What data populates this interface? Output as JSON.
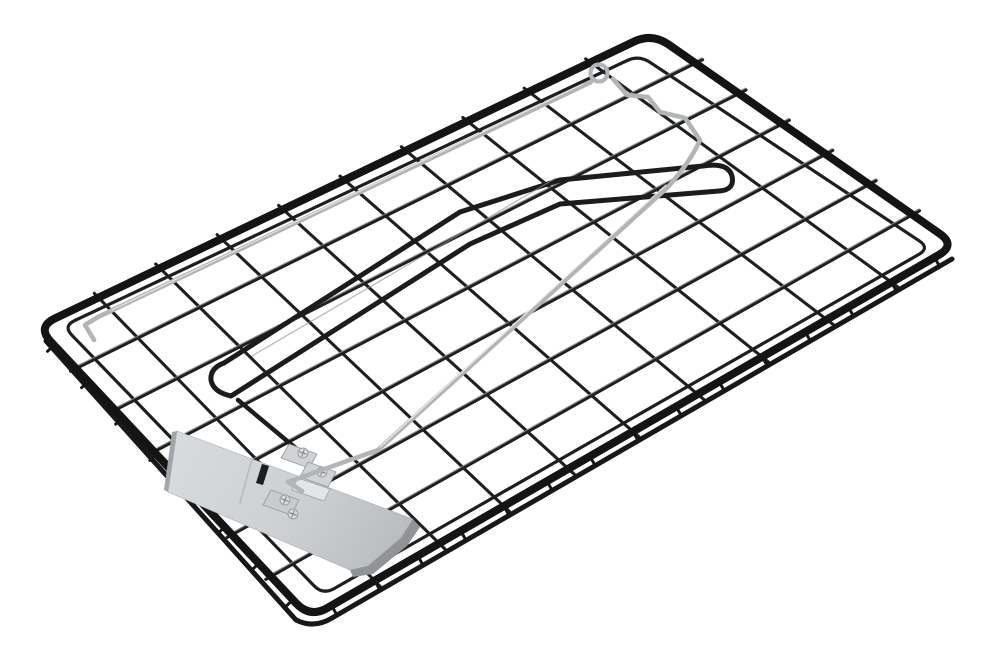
{
  "meta": {
    "description": "Isolated studio product photo on a white background: a black powder-coated wire mesh trap tray shown in perspective, fitted with a silver spring latch wire with a small eyelet loop and zig-zag bend at the top edge, a thin black striker hoop wire lying diagonally across the mesh, and a brushed-silver trigger pedal plate mounted with small screwed brackets near the lower left."
  },
  "palette": {
    "background": "#ffffff",
    "frame_black": "#141414",
    "mesh_black": "#1f1f1f",
    "wire_highlight": "#7d8184",
    "silver_wire": "#b2b5b7",
    "silver_highlight": "#eceeef",
    "plate_light": "#d8dbdd",
    "plate_dark": "#b7bbbe",
    "plate_edge": "#8f9497",
    "screw_fill": "#dcdfe1"
  },
  "figure": {
    "canvas": {
      "width": 990,
      "height": 660
    },
    "frame": {
      "corners": [
        [
          652,
          33
        ],
        [
          956,
          245
        ],
        [
          310,
          618
        ],
        [
          37,
          327
        ]
      ],
      "radius": 20,
      "color": "#141414",
      "width": 8
    },
    "innerFrame": {
      "corners": [
        [
          639,
          55
        ],
        [
          930,
          248
        ],
        [
          323,
          595
        ],
        [
          63,
          326
        ]
      ],
      "radius": 13,
      "color": "#1e1e1e",
      "width": 3.2
    },
    "mesh": {
      "cols": 10,
      "rows": 7,
      "color": "#1f1f1f",
      "width": 3.1,
      "overhang_start": 6,
      "overhang_end": 8,
      "highlight": {
        "color": "#7d8184",
        "width": 1.2,
        "dy": -2.1,
        "opacity": 0.85
      }
    },
    "lowerRim": {
      "d": "M 952,259 L 332,618 Q 314,629 296,620 L 46,341",
      "color": "#181818",
      "width": 5
    },
    "ticks": [
      {
        "from": "B",
        "to": "R",
        "count": 15,
        "len": 8,
        "dir": [
          0.5,
          0.866
        ],
        "inset": 2,
        "color": "#161616",
        "width": 3
      },
      {
        "from": "L",
        "to": "B",
        "count": 8,
        "len": 7,
        "dir": [
          -0.73,
          0.68
        ],
        "inset": 2,
        "color": "#161616",
        "width": 3
      }
    ],
    "overlays": [
      {
        "name": "striker-hoop-wire",
        "kind": "path",
        "d": "M 224,363 L 460,212 L 560,180 L 703,166 Q 728,162 732,176 Q 735,190 719,191 L 560,204 L 470,244 L 231,396 Q 213,392 211,380 Q 210,368 224,363 Z",
        "stroke": "#1c1c1c",
        "width": 5,
        "fill": "none"
      },
      {
        "name": "striker-hoop-highlight",
        "kind": "path",
        "d": "M 252,356 L 556,178",
        "stroke": "#8d9193",
        "width": 1.2,
        "fill": "none",
        "opacity": 0.65
      },
      {
        "name": "spring-arm-wire",
        "kind": "path",
        "d": "M 238,400 L 304,455",
        "stroke": "#1c1c1c",
        "width": 4.4,
        "fill": "none"
      },
      {
        "name": "trigger-plate-left-edge",
        "kind": "path",
        "d": "M 177,431 L 168,492 L 164,490 L 172,432 Z",
        "stroke": "none",
        "width": 0,
        "fill": "#a0a5a8"
      },
      {
        "name": "trigger-plate-face",
        "kind": "path",
        "d": "M 177,431 L 413,519 L 401,538 L 368,566 L 350,570 L 168,492 Z",
        "stroke": "#a6abae",
        "width": 0.6,
        "fill": "grad:plateGrad"
      },
      {
        "name": "trigger-plate-side-edge",
        "kind": "path",
        "d": "M 413,519 L 420,527 L 407,546 L 373,574 L 353,577 L 350,570 L 368,566 L 401,538 Z",
        "stroke": "none",
        "width": 0,
        "fill": "#8f9497"
      },
      {
        "name": "trigger-plate-crease",
        "kind": "path",
        "d": "M 252,459 L 240,503",
        "stroke": "#b6babc",
        "width": 1.5,
        "fill": "none"
      },
      {
        "name": "trigger-plate-latch-slot",
        "kind": "path",
        "d": "M 262,464 L 269,466 L 263,485 L 256,483 Z",
        "stroke": "none",
        "width": 0,
        "fill": "#1d1d1d"
      },
      {
        "name": "bracket-tab-lower",
        "kind": "path",
        "d": "M 271,490 L 299,500 L 291,515 L 263,505 Z",
        "stroke": "#92999c",
        "width": 0.8,
        "fill": "#c8cccf"
      },
      {
        "name": "bracket-tab-upper-1",
        "kind": "path",
        "d": "M 289,444 L 317,454 L 309,468 L 281,458 Z",
        "stroke": "#92999c",
        "width": 0.8,
        "fill": "#cfd3d5"
      },
      {
        "name": "bracket-tab-upper-2",
        "kind": "path",
        "d": "M 308,462 L 336,472 L 328,487 L 300,477 Z",
        "stroke": "#92999c",
        "width": 0.8,
        "fill": "#cfd3d5"
      },
      {
        "name": "bracket-pivot-lip",
        "kind": "path",
        "d": "M 298,478 L 330,489 L 324,501 L 292,490 Z",
        "stroke": "#9aa0a3",
        "width": 0.8,
        "fill": "#e3e6e8"
      },
      {
        "name": "bracket-screw",
        "kind": "screw",
        "cx": 303,
        "cy": 453
      },
      {
        "name": "bracket-screw",
        "kind": "screw",
        "cx": 322,
        "cy": 472
      },
      {
        "name": "bracket-screw",
        "kind": "screw",
        "cx": 285,
        "cy": 500
      },
      {
        "name": "bracket-screw",
        "kind": "screw",
        "cx": 293,
        "cy": 514
      },
      {
        "name": "latch-wire-main",
        "kind": "path",
        "d": "M 302,491 L 288,482 L 378,450 L 668,187 Q 691,161 700,140 L 685,118 L 660,112 L 648,97 L 627,95 L 613,79",
        "stroke": "#b2b5b7",
        "width": 4.6,
        "fill": "none"
      },
      {
        "name": "latch-wire-main-highlight",
        "kind": "path",
        "d": "M 380,447 L 666,185",
        "stroke": "#eceeef",
        "width": 1.3,
        "fill": "none",
        "opacity": 0.9
      },
      {
        "name": "latch-wire-long-leg",
        "kind": "path",
        "d": "M 591,82 L 98,317 L 85,325 L 94,340",
        "stroke": "#b2b5b7",
        "width": 4.6,
        "fill": "none"
      },
      {
        "name": "latch-wire-long-leg-highlight",
        "kind": "path",
        "d": "M 583,84 L 112,310",
        "stroke": "#eceeef",
        "width": 1.2,
        "fill": "none",
        "opacity": 0.85
      },
      {
        "name": "latch-eyelet-loop",
        "kind": "circle",
        "cx": 599,
        "cy": 73,
        "r": 8.5,
        "stroke": "#b2b5b7",
        "width": 4.2,
        "fill": "none"
      }
    ],
    "screw_style": {
      "r": 5,
      "fill": "#dcdfe1",
      "rim": "#999ea1",
      "rim_width": 1,
      "cross": "#878d90",
      "cross_width": 1.3,
      "cross_len": 3.4
    }
  }
}
